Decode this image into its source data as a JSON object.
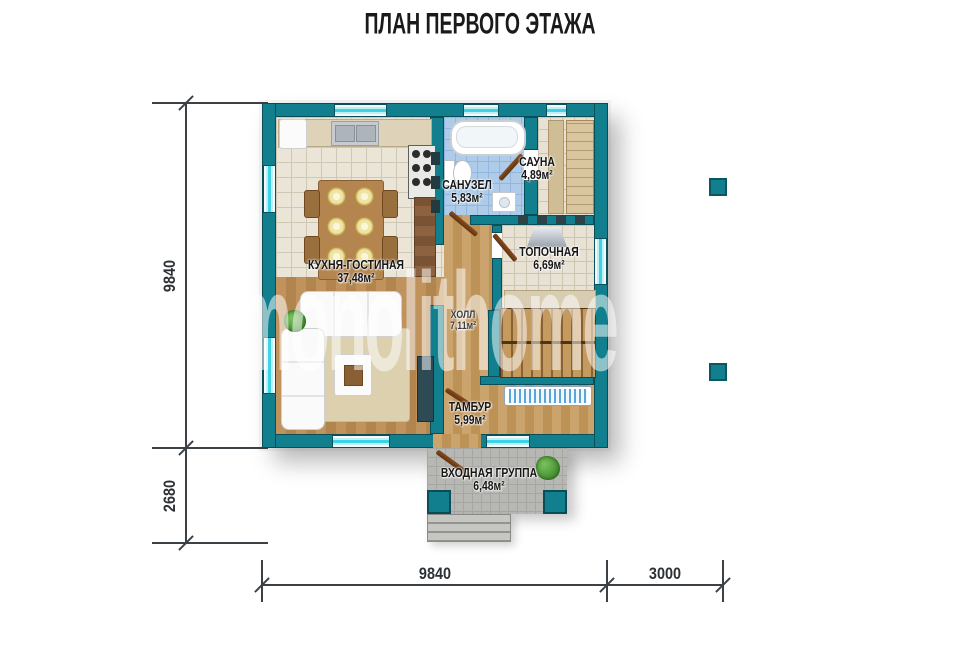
{
  "title": "ПЛАН ПЕРВОГО ЭТАЖА",
  "watermark": "monolithome",
  "rooms": [
    {
      "id": "kitchen-living",
      "name": "КУХНЯ-ГОСТИНАЯ",
      "area": "37,48м²"
    },
    {
      "id": "bathroom",
      "name": "САНУЗЕЛ",
      "area": "5,83м²"
    },
    {
      "id": "sauna",
      "name": "САУНА",
      "area": "4,89м²"
    },
    {
      "id": "boiler-room",
      "name": "ТОПОЧНАЯ",
      "area": "6,69м²"
    },
    {
      "id": "hall",
      "name": "ХОЛЛ",
      "area": "7,11м²"
    },
    {
      "id": "vestibule",
      "name": "ТАМБУР",
      "area": "5,99м²"
    },
    {
      "id": "entrance-group",
      "name": "ВХОДНАЯ ГРУППА",
      "area": "6,48м²"
    }
  ],
  "dimensions": {
    "left_main": "9840",
    "left_lower": "2680",
    "bottom_main": "9840",
    "bottom_right": "3000"
  },
  "colors": {
    "wall_teal": "#127F8E",
    "wall_outline": "#0A4F5B",
    "window_glass": "#3FD2E4",
    "wood_floor": "#B98A52",
    "bath_tile": "#AECBE9",
    "dimension_line": "#3C4146"
  }
}
